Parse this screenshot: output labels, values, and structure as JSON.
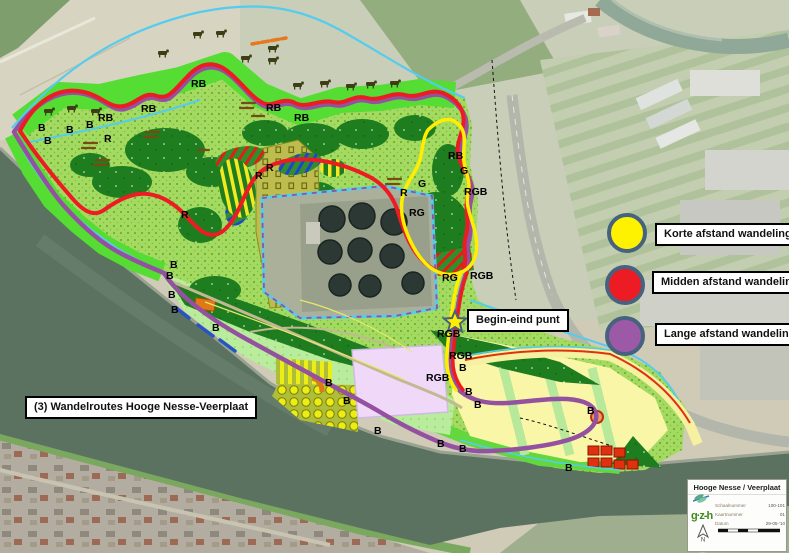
{
  "map_title": {
    "label": "(3) Wandelroutes Hooge Nesse-Veerplaat"
  },
  "begin_end": {
    "label": "Begin-eind punt"
  },
  "legend": {
    "ring_color": "#46627f",
    "items": [
      {
        "id": "korte",
        "color": "#fff200",
        "label": "Korte afstand wandeling"
      },
      {
        "id": "midden",
        "color": "#ed1c24",
        "label": "Midden afstand wandeling"
      },
      {
        "id": "lange",
        "color": "#9c59a5",
        "label": "Lange afstand wandeling"
      }
    ]
  },
  "routes": {
    "korte_color": "#ffee00",
    "midden_color": "#ed1c24",
    "lange_color": "#9451a0",
    "water_color": "#55ccee"
  },
  "map_labels": [
    {
      "t": "B",
      "x": 38,
      "y": 131
    },
    {
      "t": "B",
      "x": 44,
      "y": 144
    },
    {
      "t": "B",
      "x": 66,
      "y": 133
    },
    {
      "t": "B",
      "x": 86,
      "y": 128
    },
    {
      "t": "RB",
      "x": 98,
      "y": 121
    },
    {
      "t": "RB",
      "x": 141,
      "y": 112
    },
    {
      "t": "RB",
      "x": 191,
      "y": 87
    },
    {
      "t": "RB",
      "x": 266,
      "y": 111
    },
    {
      "t": "RB",
      "x": 294,
      "y": 121
    },
    {
      "t": "RB",
      "x": 448,
      "y": 159
    },
    {
      "t": "R",
      "x": 104,
      "y": 142
    },
    {
      "t": "R",
      "x": 181,
      "y": 218
    },
    {
      "t": "R",
      "x": 255,
      "y": 179
    },
    {
      "t": "R",
      "x": 266,
      "y": 171
    },
    {
      "t": "R",
      "x": 400,
      "y": 196
    },
    {
      "t": "G",
      "x": 418,
      "y": 187
    },
    {
      "t": "G",
      "x": 460,
      "y": 174
    },
    {
      "t": "RG",
      "x": 409,
      "y": 216
    },
    {
      "t": "RG",
      "x": 442,
      "y": 281
    },
    {
      "t": "RGB",
      "x": 464,
      "y": 195
    },
    {
      "t": "RGB",
      "x": 470,
      "y": 279
    },
    {
      "t": "RGB",
      "x": 437,
      "y": 337
    },
    {
      "t": "RGB",
      "x": 449,
      "y": 359
    },
    {
      "t": "RGB",
      "x": 426,
      "y": 381
    },
    {
      "t": "B",
      "x": 459,
      "y": 371
    },
    {
      "t": "B",
      "x": 465,
      "y": 395
    },
    {
      "t": "B",
      "x": 474,
      "y": 408
    },
    {
      "t": "B",
      "x": 587,
      "y": 414
    },
    {
      "t": "B",
      "x": 437,
      "y": 447
    },
    {
      "t": "B",
      "x": 459,
      "y": 452
    },
    {
      "t": "B",
      "x": 565,
      "y": 471
    },
    {
      "t": "B",
      "x": 325,
      "y": 386
    },
    {
      "t": "B",
      "x": 343,
      "y": 404
    },
    {
      "t": "B",
      "x": 374,
      "y": 434
    },
    {
      "t": "B",
      "x": 170,
      "y": 268
    },
    {
      "t": "B",
      "x": 166,
      "y": 279
    },
    {
      "t": "B",
      "x": 168,
      "y": 298
    },
    {
      "t": "B",
      "x": 171,
      "y": 313
    },
    {
      "t": "B",
      "x": 212,
      "y": 331
    }
  ],
  "cows": [
    [
      44,
      108
    ],
    [
      67,
      105
    ],
    [
      91,
      108
    ],
    [
      158,
      50
    ],
    [
      193,
      31
    ],
    [
      216,
      30
    ],
    [
      241,
      55
    ],
    [
      268,
      45
    ],
    [
      268,
      57
    ],
    [
      293,
      82
    ],
    [
      320,
      80
    ],
    [
      346,
      83
    ],
    [
      366,
      81
    ],
    [
      390,
      80
    ]
  ],
  "info_card": {
    "title": "Hooge Nesse / Veerplaat",
    "rows": [
      {
        "label": "Schaalnummer",
        "value": "100-101"
      },
      {
        "label": "Kaartnummer",
        "value": "01"
      },
      {
        "label": "Datum",
        "value": "29-05-'10"
      }
    ],
    "logo_text": "g·z-h",
    "north_label": "N"
  }
}
